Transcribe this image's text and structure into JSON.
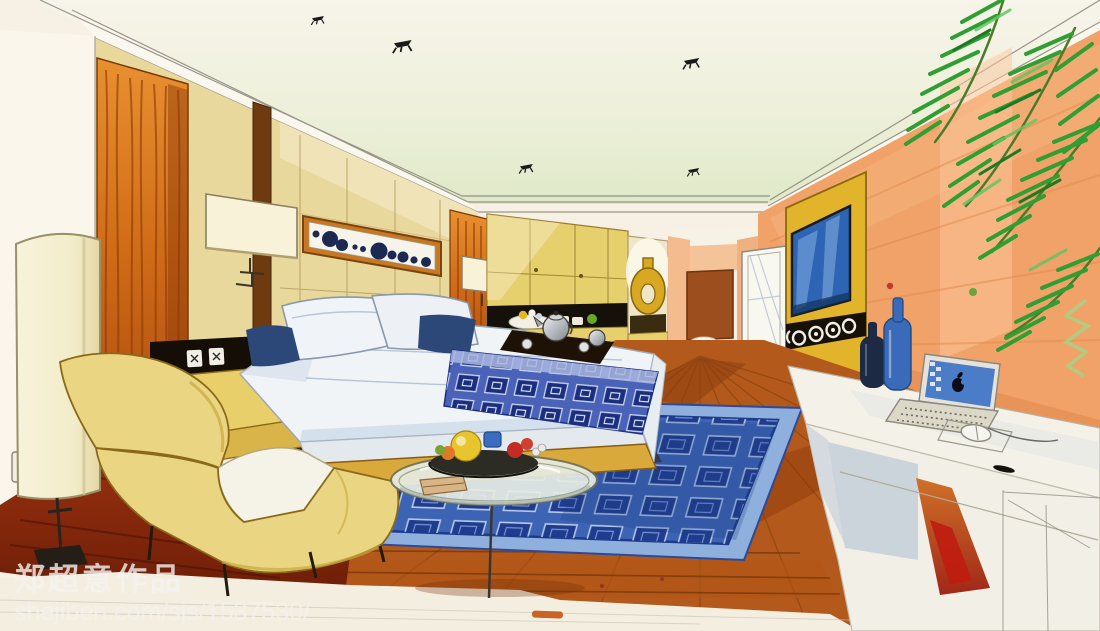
{
  "canvas": {
    "width": 1100,
    "height": 631
  },
  "artwork": {
    "type": "hand-drawn marker rendering",
    "subject": "hotel bedroom interior perspective sketch"
  },
  "watermark": {
    "artist_line": "郑超意作品",
    "url_line": "shejiben.com/sjs/1537530/"
  },
  "palette": {
    "paper": "#f6f1e4",
    "ceiling_tint": "#e7eed6",
    "wall_tan": "#e9d89c",
    "cabinet_yellow": "#e6cf6d",
    "wall_peach": "#f0a269",
    "tv_panel": "#e2b42c",
    "tv_screen": "#2e64b4",
    "speaker_black": "#161009",
    "door_brown": "#9c4e1e",
    "door_white": "#f8f7f0",
    "rug_border": "#8fb0dc",
    "rug_blue": "#3c63b4",
    "runner_blue": "#4a62b8",
    "bed_white": "#f1f4f6",
    "pillow_navy": "#2c4878",
    "chaise_yellow": "#ead583",
    "cushion_white": "#f5f3e8",
    "bed_base_gold": "#d9a93c",
    "ledge_yellow": "#e8cf6a",
    "floor_wood": "#b3591b",
    "floor_maroon": "#8e2c0e",
    "lamp_cream": "#f4efd2",
    "plant_green": "#2f9e33",
    "vase_gold": "#d9a822",
    "bottle_blue": "#3a6ab8",
    "bottle_navy": "#1c2a44",
    "laptop_screen": "#4a7cc8",
    "sideboard_white": "#f4f1e8",
    "wood_grain_orange": "#d06c1a"
  },
  "scene_elements": [
    "ceiling-spotlights",
    "crown-molding",
    "wood-grain-panels",
    "wall-lamps",
    "abstract-artwork",
    "power-outlets",
    "headboard-wall",
    "wardrobe-cabinets",
    "display-niche-with-bowls",
    "ring-vase",
    "corridor-door",
    "white-door",
    "tv-media-panel",
    "speaker-strip",
    "palm-plant",
    "sideboard-desk",
    "laptop-with-apple-logo",
    "computer-mouse",
    "decor-bottles",
    "bed",
    "pillows",
    "tea-tray-with-teapot",
    "patterned-bed-runner",
    "area-rug",
    "chaise-lounge",
    "glass-coffee-table",
    "fruit-bowl",
    "floor-lamp",
    "wood-floor",
    "maroon-floor-shadow"
  ]
}
